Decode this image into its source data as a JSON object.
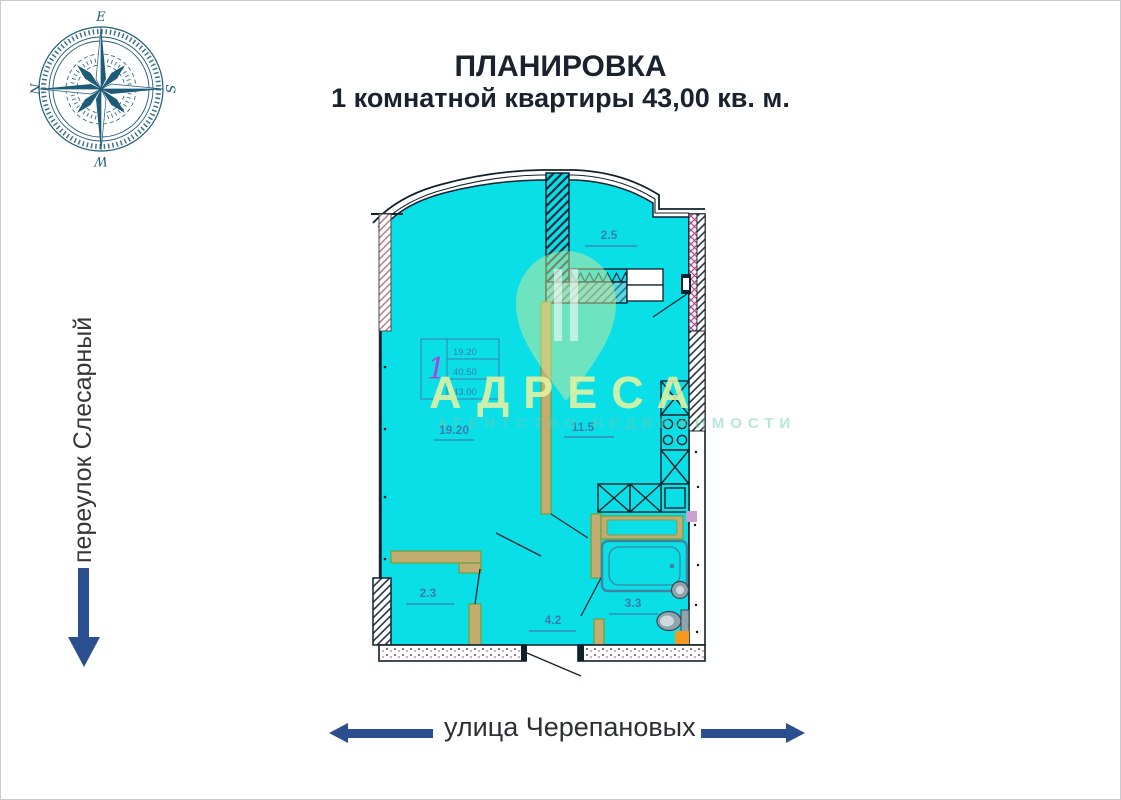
{
  "title": {
    "line1": "ПЛАНИРОВКА",
    "line2": "1 комнатной квартиры 43,00 кв. м."
  },
  "compass": {
    "top": "E",
    "right": "S",
    "bottom": "W",
    "left": "N"
  },
  "streets": {
    "left": "переулок Слесарный",
    "bottom": "улица Черепановых"
  },
  "plan": {
    "rooms": {
      "balcony": {
        "label": "2.5"
      },
      "living": {
        "label": "19.20"
      },
      "kitchen": {
        "label": "11.5"
      },
      "closet": {
        "label": "2.3"
      },
      "hallway": {
        "label": "4.2"
      },
      "bathroom": {
        "label": "3.3"
      }
    },
    "info_box": {
      "flat_number": "1",
      "row1": "19.20",
      "row2": "40.50",
      "row3": "43.00"
    }
  },
  "watermark": {
    "title": "АДРЕСА",
    "subtitle": "АГЕНТСТВО НЕДВИЖИМОСТИ"
  },
  "colors": {
    "plan_fill": "#0adfe8",
    "wall_dark": "#16222c",
    "label_blue": "#3b7cb0",
    "partition_olive": "#c2ac70",
    "accent_blue": "#2b4f8e",
    "compass_teal": "#1d5b78",
    "orange": "#f6991c"
  }
}
